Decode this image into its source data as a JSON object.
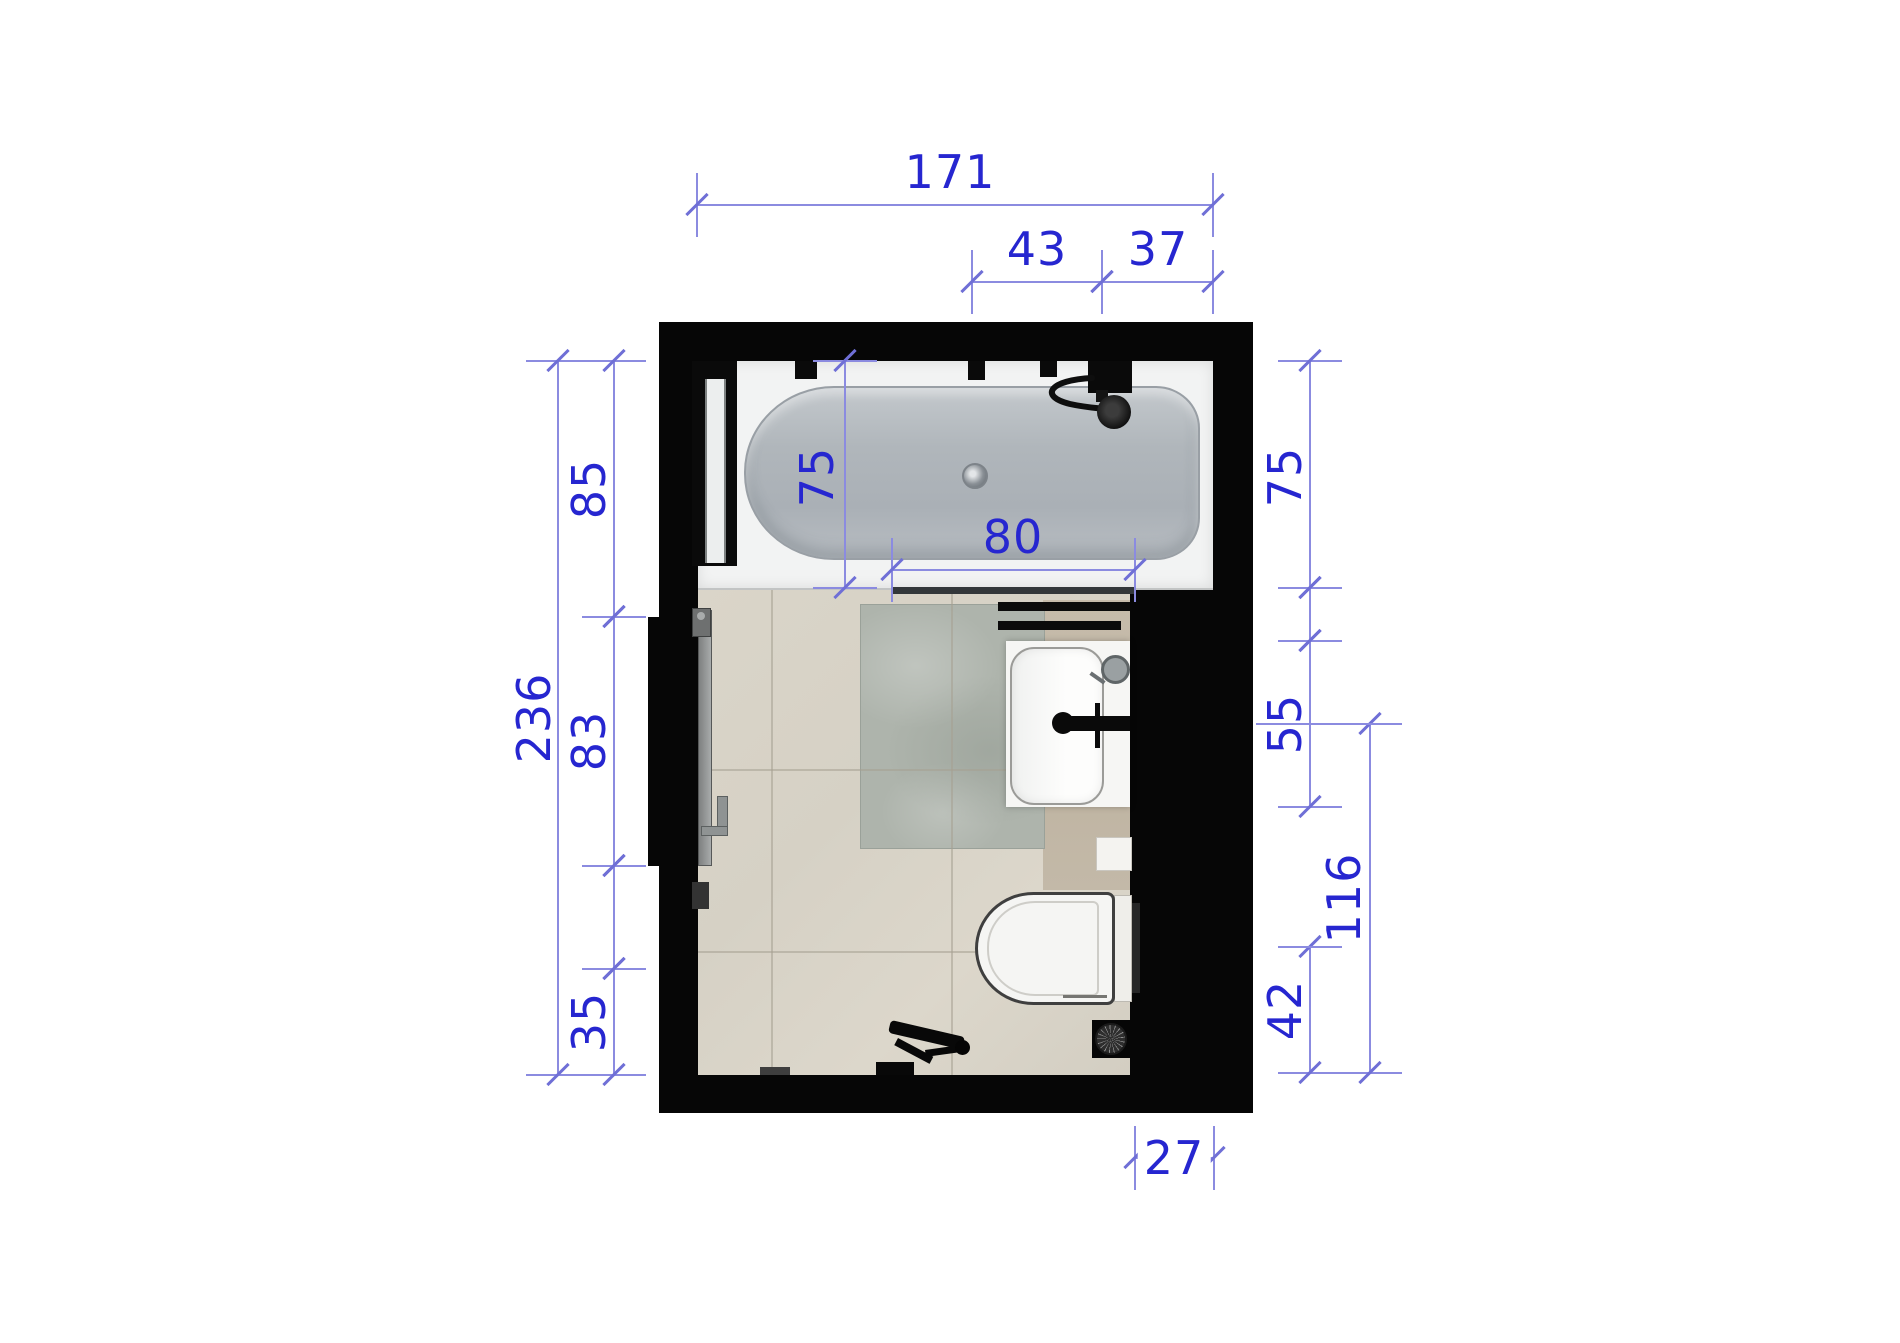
{
  "drawing": {
    "kind": "bathroom-floor-plan-top-view",
    "colors": {
      "background": "#ffffff",
      "wall": "#060606",
      "dimension_line": "#8b8be0",
      "dimension_tick": "#6f6fd6",
      "dimension_text": "#2626d0",
      "floor_tile": "#d8d3c7",
      "accent_tile": "#bfb4a2",
      "shower_mat": "#aeb4ac",
      "bathtub_basin": "#b0b6bb"
    },
    "fixtures": [
      "bathtub",
      "bath-screen",
      "shower-mixer",
      "shower-head",
      "towel-bars",
      "vanity-sink",
      "faucet",
      "cosmetic-mirror",
      "wall-shelf",
      "toilet",
      "flush-plate",
      "floor-drain",
      "door-leaf",
      "door-handle",
      "shower-mat"
    ],
    "dimensions": [
      {
        "id": "room-width",
        "label": "171",
        "axis": "h",
        "x1": 697,
        "x2": 1213,
        "y": 205,
        "lx": 950,
        "ly": 172
      },
      {
        "id": "shower-span",
        "label": "43",
        "axis": "h",
        "x1": 972,
        "x2": 1102,
        "y": 282,
        "lx": 1037,
        "ly": 249
      },
      {
        "id": "mixer-to-wall",
        "label": "37",
        "axis": "h",
        "x1": 1102,
        "x2": 1213,
        "y": 282,
        "lx": 1158,
        "ly": 249
      },
      {
        "id": "bath-screen-length",
        "label": "80",
        "axis": "h",
        "x1": 892,
        "x2": 1135,
        "y": 570,
        "lx": 1013,
        "ly": 537
      },
      {
        "id": "niche-depth",
        "label": "27",
        "axis": "h",
        "x1": 1135,
        "x2": 1214,
        "y": 1158,
        "lx": 1174,
        "ly": 1158,
        "on_line": true
      },
      {
        "id": "room-height",
        "label": "236",
        "axis": "v",
        "y1": 361,
        "y2": 1075,
        "x": 558,
        "lx": 534,
        "ly": 718
      },
      {
        "id": "bath-zone",
        "label": "85",
        "axis": "v",
        "y1": 361,
        "y2": 617,
        "x": 614,
        "lx": 589,
        "ly": 489
      },
      {
        "id": "door-zone",
        "label": "83",
        "axis": "v",
        "y1": 617,
        "y2": 866,
        "x": 614,
        "lx": 589,
        "ly": 741
      },
      {
        "id": "left-mid-span",
        "label": "",
        "axis": "v",
        "y1": 866,
        "y2": 969,
        "x": 614
      },
      {
        "id": "left-bottom-span",
        "label": "35",
        "axis": "v",
        "y1": 969,
        "y2": 1075,
        "x": 614,
        "lx": 589,
        "ly": 1022
      },
      {
        "id": "bath-width-inner",
        "label": "75",
        "axis": "v",
        "y1": 361,
        "y2": 588,
        "x": 845,
        "lx": 817,
        "ly": 477
      },
      {
        "id": "bath-width-right",
        "label": "75",
        "axis": "v",
        "y1": 361,
        "y2": 588,
        "x": 1310,
        "lx": 1285,
        "ly": 477
      },
      {
        "id": "right-gap-span",
        "label": "",
        "axis": "v",
        "y1": 588,
        "y2": 641,
        "x": 1310
      },
      {
        "id": "vanity-width",
        "label": "55",
        "axis": "v",
        "y1": 641,
        "y2": 807,
        "x": 1310,
        "lx": 1285,
        "ly": 724
      },
      {
        "id": "toilet-to-wall",
        "label": "42",
        "axis": "v",
        "y1": 947,
        "y2": 1073,
        "x": 1310,
        "lx": 1285,
        "ly": 1010
      },
      {
        "id": "sink-axis-to-wall",
        "label": "116",
        "axis": "v",
        "y1": 724,
        "y2": 1073,
        "x": 1370,
        "lx": 1344,
        "ly": 898
      }
    ],
    "aux_lines": [
      {
        "axis": "h",
        "x1": 1256,
        "x2": 1392,
        "y": 724
      },
      {
        "axis": "h",
        "x1": 1282,
        "x2": 1338,
        "y": 947
      }
    ]
  }
}
